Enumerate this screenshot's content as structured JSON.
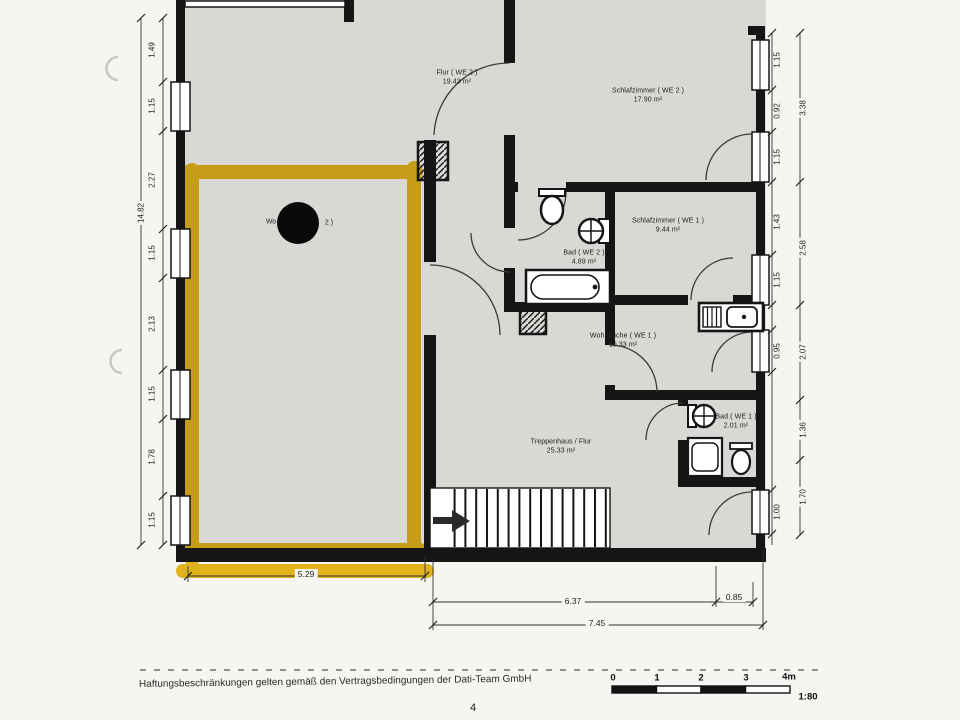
{
  "document": {
    "footer": "Haftungsbeschränkungen gelten gemäß den Vertragsbedingungen der Dati-Team GmbH",
    "page_number": "4"
  },
  "scale_bar": {
    "ticks": [
      "0",
      "1",
      "2",
      "3"
    ],
    "end": "4m",
    "ratio": "1:80"
  },
  "rooms": {
    "flur_we2": {
      "label": "Flur ( WE 2 )",
      "area": "19.43 m²"
    },
    "schlafzimmer_we2": {
      "label": "Schlafzimmer ( WE 2 )",
      "area": "17.90 m²"
    },
    "wohnraum_we2": {
      "label_prefix": "Wo",
      "label_suffix": "2 )"
    },
    "bad_we2": {
      "label": "Bad ( WE 2 )",
      "area": "4.89 m²"
    },
    "schlafzimmer_we1": {
      "label": "Schlafzimmer ( WE 1 )",
      "area": "9.44 m²"
    },
    "wohnkueche_we1": {
      "label": "Wohnküche ( WE 1 )",
      "area": "10.33 m²"
    },
    "bad_we1": {
      "label": "Bad ( WE 1 )",
      "area": "2.01 m²"
    },
    "treppenhaus": {
      "label": "Treppenhaus / Flur",
      "area": "25.33 m²"
    }
  },
  "dimensions": {
    "left_total": "14.82",
    "left": [
      "1.49",
      "1.15",
      "2.27",
      "1.15",
      "2.13",
      "1.15",
      "1.78",
      "1.15"
    ],
    "right_inner": [
      "1.15",
      "0.92",
      "1.15",
      "1.43",
      "1.15",
      "0.95",
      "1.00"
    ],
    "right_outer": [
      "3.38",
      "2.58",
      "2.07",
      "1.36",
      "1.70"
    ],
    "bottom_highlight": "5.29",
    "bottom_a": "6.37",
    "bottom_b": "0.85",
    "bottom_total": "7.45"
  },
  "colors": {
    "highlight": "#e7b40a",
    "wall": "#151515",
    "paper": "#d9d8d4"
  }
}
